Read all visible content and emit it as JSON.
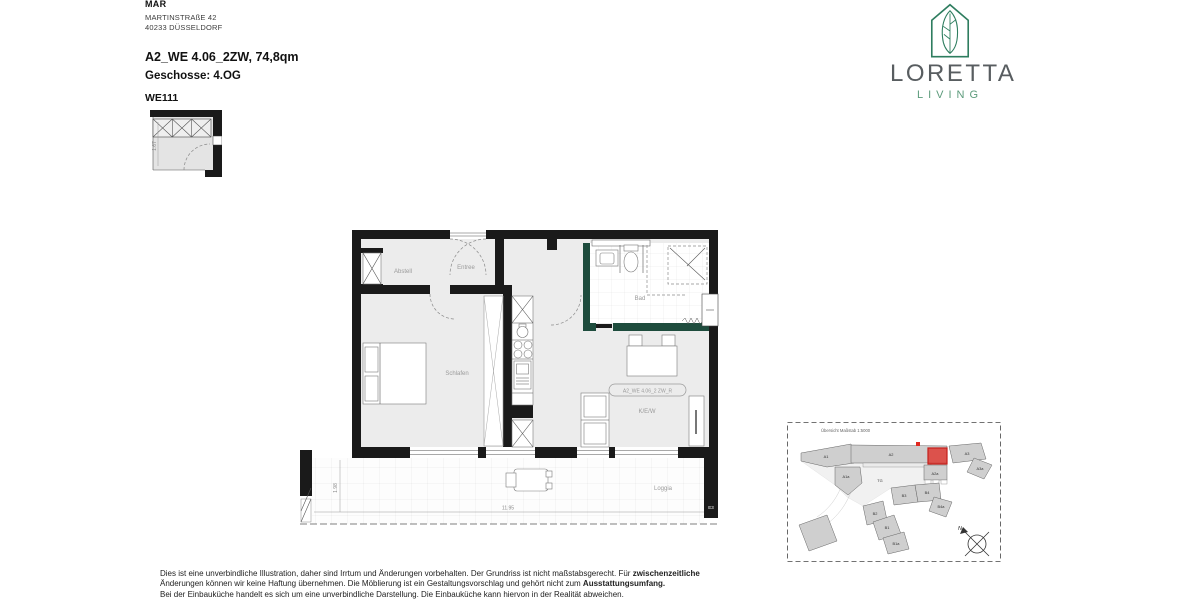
{
  "header": {
    "company": "MAR",
    "address_line1": "MARTINSTRAßE 42",
    "address_line2": "40233 DÜSSELDORF",
    "unit_title": "A2_WE 4.06_2ZW, 74,8qm",
    "floor_label": "Geschosse: 4.OG",
    "unit_code": "WE111",
    "thumb_dim": "1.67"
  },
  "brand": {
    "name": "LORETTA",
    "subline": "LIVING",
    "green": "#2E7D5F",
    "text_gray": "#585D60"
  },
  "floorplan": {
    "room_labels": {
      "abstell": "Abstell",
      "entree": "Entree",
      "bad": "Bad",
      "schlafen": "Schlafen",
      "kew": "K/E/W",
      "loggia": "Loggia"
    },
    "unit_tag": "A2_WE 4.06_2 ZW_R",
    "dim_loggia_depth": "1.98",
    "dim_loggia_width": "11.95",
    "section_marker": "E3",
    "wall_color": "#1A1A1A",
    "bath_wall_color": "#1E4C3D"
  },
  "siteplan": {
    "title": "Übersicht Maßstab 1:5000",
    "buildings": [
      "A1",
      "A2",
      "A3",
      "A3a",
      "A1a",
      "A2a",
      "TG",
      "B3",
      "B4",
      "B4a",
      "B2",
      "B1",
      "B1a"
    ],
    "compass": "N",
    "highlight_color": "#E02820"
  },
  "footer": {
    "line1": "Dies ist eine unverbindliche Illustration, daher sind Irrtum und Änderungen vorbehalten. Der Grundriss ist nicht maßstabsgerecht. Für ",
    "line1_bold": "zwischenzeitliche",
    "line2": "Änderungen können wir keine Haftung übernehmen. Die Möblierung ist ein Gestaltungsvorschlag und gehört nicht zum ",
    "line2_bold": "Ausstattungsumfang.",
    "line3": "Bei der Einbauküche handelt es sich um eine unverbindliche Darstellung. Die Einbauküche kann hiervon in der Realität abweichen."
  }
}
